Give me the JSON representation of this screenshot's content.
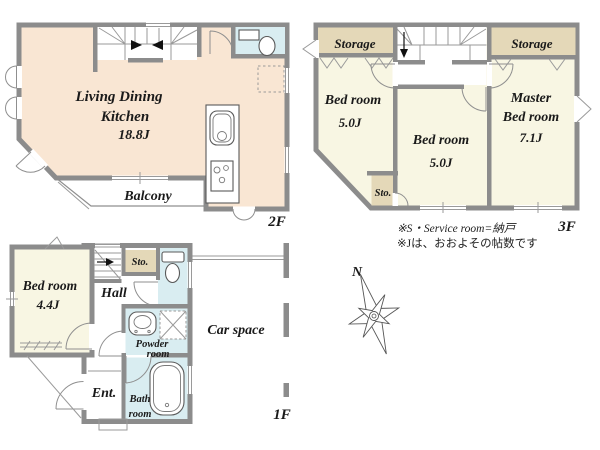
{
  "colors": {
    "wall": "#8c8c8c",
    "ldk": "#f9e6d3",
    "bedroom": "#f8f6e3",
    "storage": "#e4d8b8",
    "wet": "#d9edf1"
  },
  "floor2": {
    "label": "2F",
    "ldk_line1": "Living Dining",
    "ldk_line2": "Kitchen",
    "ldk_size": "18.8J",
    "balcony": "Balcony"
  },
  "floor3": {
    "label": "3F",
    "storage_left": "Storage",
    "storage_right": "Storage",
    "bed_left": "Bed room",
    "bed_left_size": "5.0J",
    "bed_mid": "Bed room",
    "bed_mid_size": "5.0J",
    "master_line1": "Master",
    "master_line2": "Bed room",
    "master_size": "7.1J",
    "sto": "Sto."
  },
  "floor1": {
    "label": "1F",
    "bed": "Bed room",
    "bed_size": "4.4J",
    "hall": "Hall",
    "sto": "Sto.",
    "powder_line1": "Powder",
    "powder_line2": "room",
    "bath_line1": "Bath",
    "bath_line2": "room",
    "ent": "Ent.",
    "car_space": "Car space"
  },
  "notes": {
    "line1": "※S・Service room=納戸",
    "line2": "※Jは、おおよその帖数です"
  },
  "compass": {
    "north": "N"
  }
}
